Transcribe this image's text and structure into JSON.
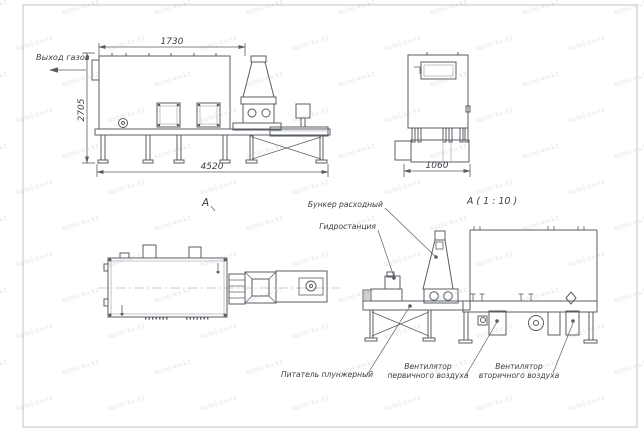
{
  "labels": {
    "gas_outlet": "Выход газов",
    "section_a": "А",
    "detail_title": "А ( 1 : 10 )",
    "bunker": "Бункер расходный",
    "hydro": "Гидростанция",
    "feeder": "Питатель плунжерный",
    "fan_primary_1": "Вентилятор",
    "fan_primary_2": "первичного воздуха",
    "fan_secondary_1": "Вентилятор",
    "fan_secondary_2": "вторичного воздуха"
  },
  "dimensions": {
    "top_width": "1730",
    "height": "2705",
    "overall_length": "4520",
    "end_width": "1060"
  },
  "watermark": {
    "text": "kotel-kv.kz"
  },
  "colors": {
    "line": "#585d63",
    "thin_line": "#9aa0a6",
    "text": "#3a3f45",
    "watermark": "#aab2bc",
    "frame": "#c2c6ca",
    "background": "#ffffff"
  }
}
